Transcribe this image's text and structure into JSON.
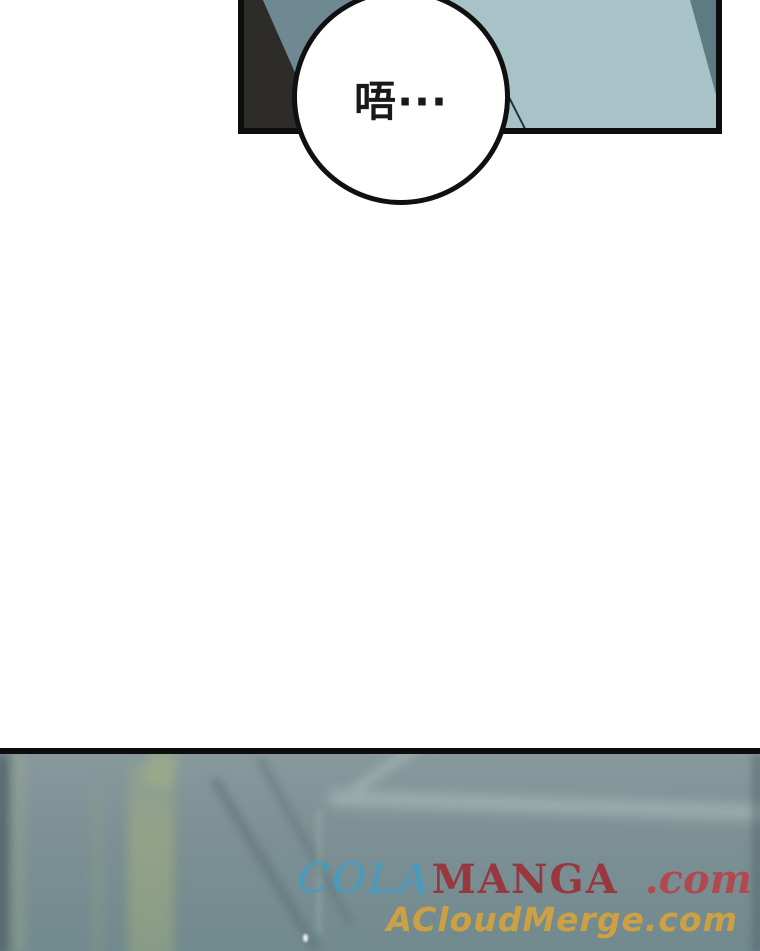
{
  "meta": {
    "width_px": 760,
    "height_px": 951,
    "page_background": "#ffffff",
    "content_type": "webtoon-strip-segment"
  },
  "top_panel": {
    "speech_bubble": {
      "text": "唔···"
    },
    "colors": {
      "panel_light_teal": "#a8c3c7",
      "panel_mid_teal": "#6e8992",
      "panel_dark_wedge": "#2d2c28",
      "panel_corner_shade": "#5d7b83",
      "panel_border": "#0d0d0d",
      "bubble_fill": "#ffffff",
      "bubble_border": "#101010",
      "bubble_text": "#191919"
    }
  },
  "bottom_panel": {
    "colors": {
      "base_top": "#87999c",
      "base_mid": "#7c9094",
      "base_bottom": "#718a8e",
      "beam_sage": "#a2ae80",
      "border_top": "#0d0d0d"
    },
    "watermarks": {
      "line1": {
        "cola": "COLA",
        "manga": "MANGA",
        "suffix": ".com",
        "cola_color": "#3f9fc8",
        "manga_color": "#9c3039",
        "suffix_color": "#b8444b"
      },
      "line2": {
        "text": "ACloudMerge.com",
        "color": "#d8a33c"
      }
    }
  }
}
